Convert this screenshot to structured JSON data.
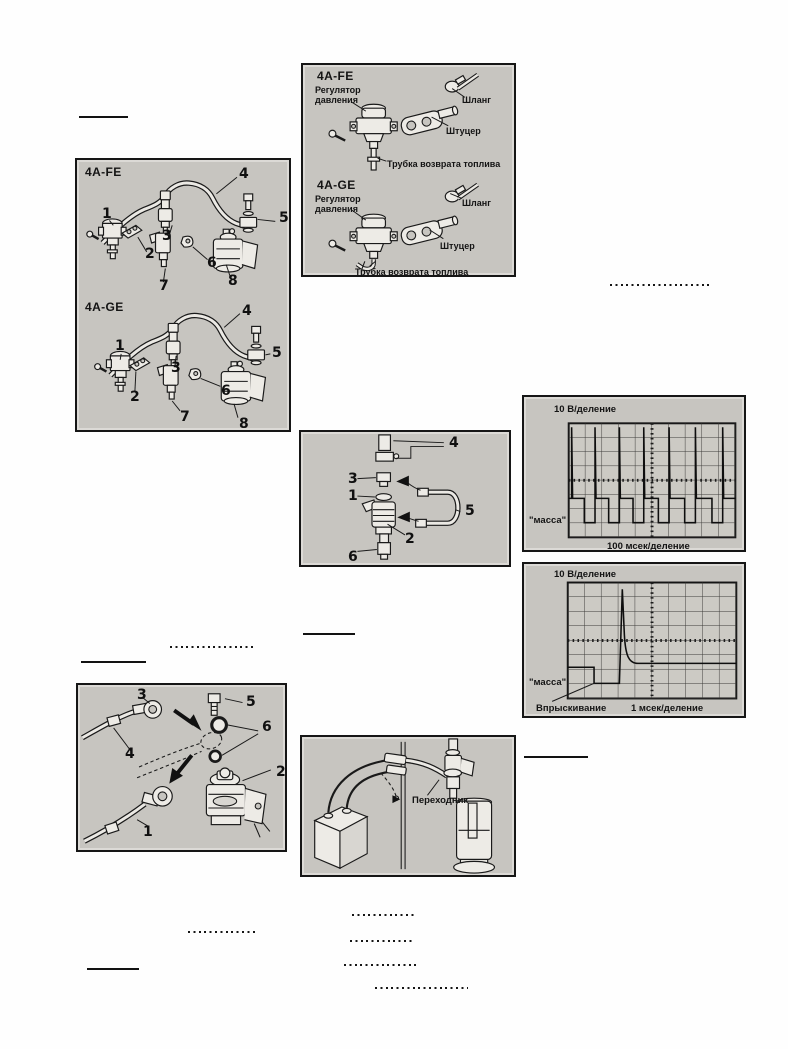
{
  "figures": {
    "fuel_system_components": {
      "engine_labels": [
        "4A-FE",
        "4A-GE"
      ],
      "callouts": [
        "1",
        "2",
        "3",
        "4",
        "5",
        "6",
        "7",
        "8"
      ]
    },
    "pressure_regulator": {
      "engine_labels": [
        "4A-FE",
        "4A-GE"
      ],
      "part_labels": {
        "regulator": "Регулятор давления",
        "hose": "Шланг",
        "union": "Штуцер",
        "return_pipe": "Трубка возврата топлива"
      }
    },
    "injector_assembly": {
      "callouts": [
        "1",
        "2",
        "3",
        "4",
        "5",
        "6"
      ]
    },
    "oscillogram_operation": {
      "voltage_scale": "10 В/деление",
      "ground": "\"масса\"",
      "time_scale": "100 мсек/деление"
    },
    "oscillogram_injection": {
      "voltage_scale": "10 В/деление",
      "ground": "\"масса\"",
      "event": "Впрыскивание",
      "time_scale": "1 мсек/деление"
    },
    "hose_connection": {
      "callouts": [
        "1",
        "2",
        "3",
        "4",
        "5",
        "6"
      ]
    },
    "injector_volume_test": {
      "adapter": "Переходник"
    }
  }
}
